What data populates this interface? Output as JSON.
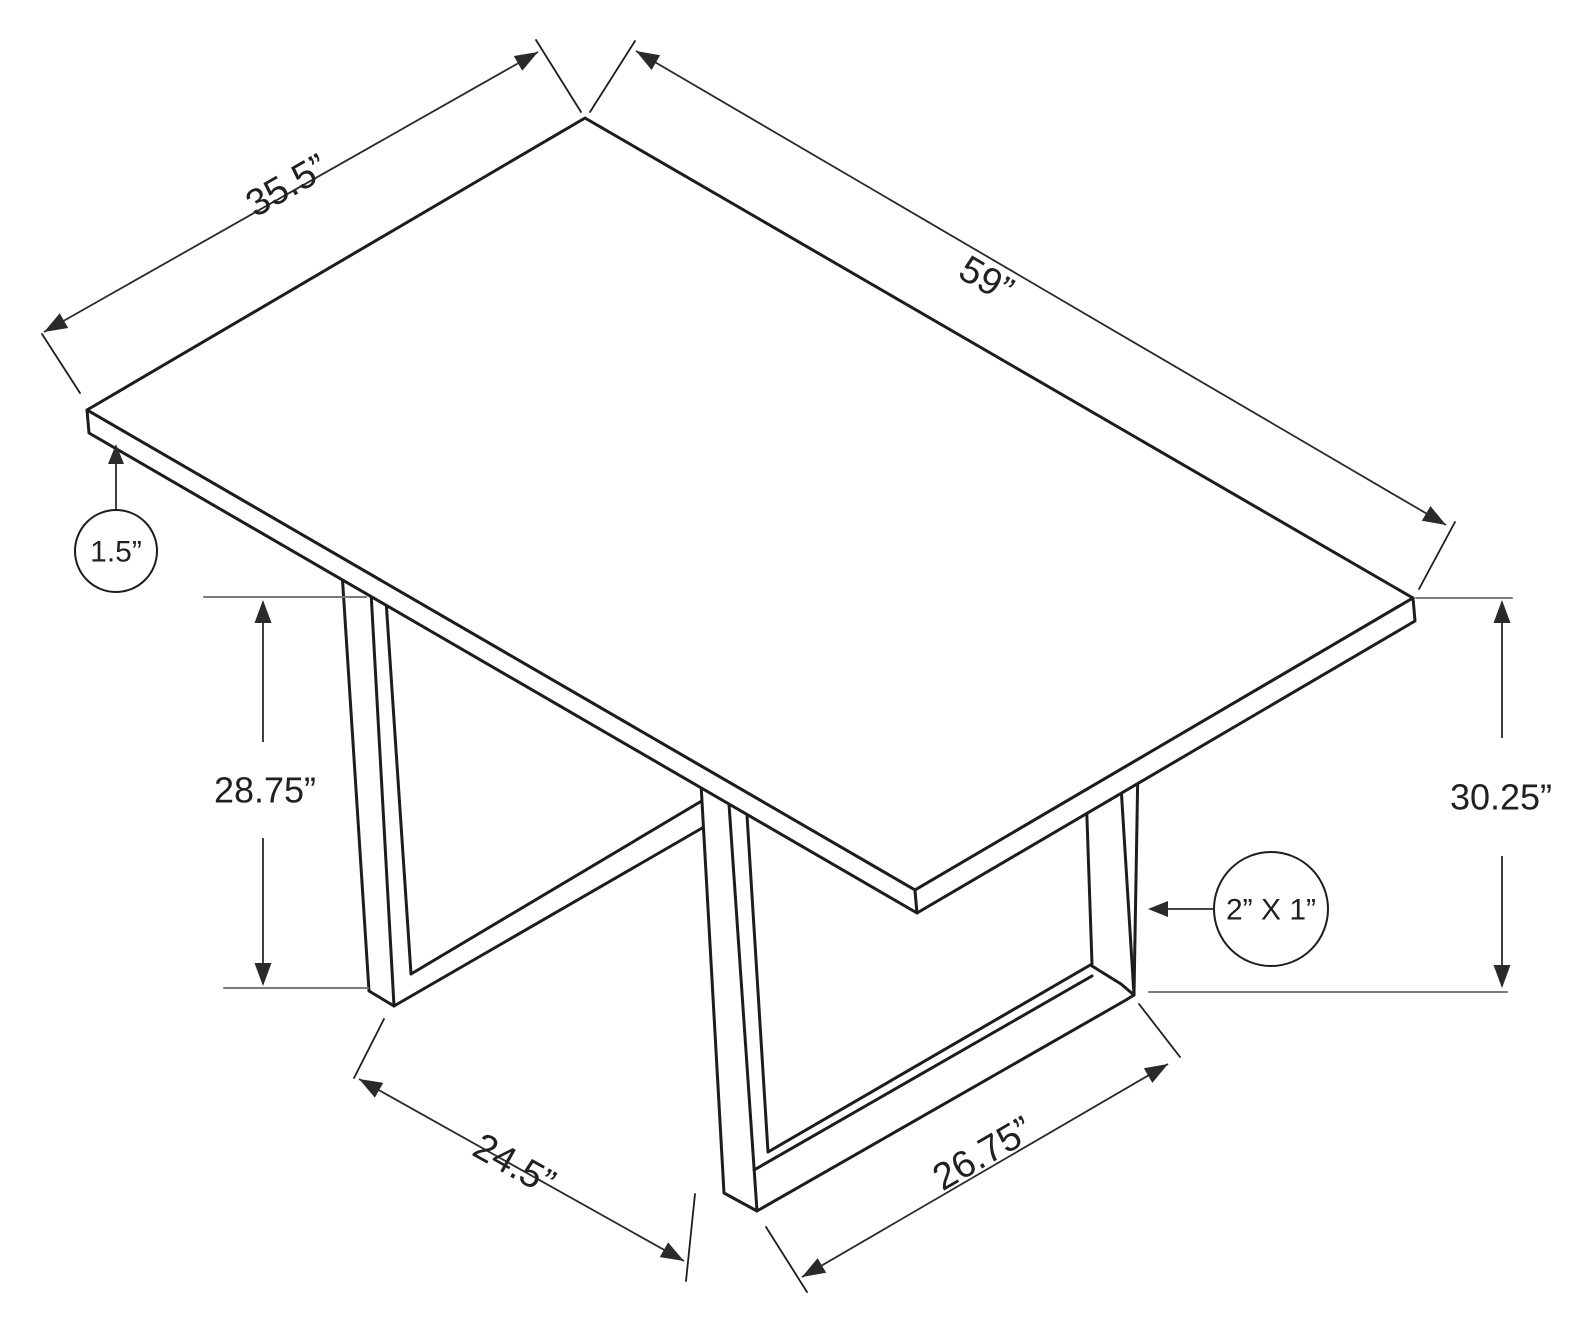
{
  "page": {
    "kind": "furniture dimension line drawing",
    "subject": "rectangular dining table with two U-shaped tube legs, isometric view"
  },
  "colors": {
    "background": "#ffffff",
    "line": "#1d1d1f",
    "dim_line": "#2a2a2c",
    "tick": "#7a7a7a",
    "text": "#231f20"
  },
  "canvas": {
    "width": 1585,
    "height": 1330
  },
  "chart_data": {
    "type": "table",
    "title": "Table dimensions (inches)",
    "dimension_labels": [
      "35.5”",
      "59”",
      "1.5”",
      "28.75”",
      "30.25”",
      "2” X 1”",
      "24.5”",
      "26.75”"
    ]
  },
  "diagram": {
    "elements": [
      {
        "type": "polygon",
        "name": "left-leg",
        "w": 3,
        "points": [
          [
            342,
            572
          ],
          [
            369,
            991
          ],
          [
            394,
            1006
          ],
          [
            742,
            805
          ],
          [
            742,
            777
          ],
          [
            411,
            974
          ],
          [
            386,
            600
          ]
        ]
      },
      {
        "type": "line",
        "name": "left-leg-front-corner-edge",
        "w": 3,
        "points": [
          [
            371,
            592
          ],
          [
            394,
            1006
          ]
        ]
      },
      {
        "type": "polygon",
        "name": "right-leg",
        "w": 3,
        "points": [
          [
            700,
            766
          ],
          [
            724,
            1193
          ],
          [
            757,
            1211
          ],
          [
            1126,
            1000
          ],
          [
            1134,
            995
          ],
          [
            1138,
            763
          ],
          [
            1085,
            761
          ],
          [
            1092,
            964
          ],
          [
            768,
            1152
          ],
          [
            745,
            783
          ]
        ]
      },
      {
        "type": "line",
        "name": "right-leg-front-corner-edge",
        "w": 3,
        "points": [
          [
            727,
            775
          ],
          [
            757,
            1211
          ]
        ]
      },
      {
        "type": "line",
        "name": "right-leg-rail-top-front-edge",
        "w": 3,
        "points": [
          [
            754,
            1170
          ],
          [
            1092,
            976
          ]
        ]
      },
      {
        "type": "line",
        "name": "right-leg-back-post-corner-edge",
        "w": 3,
        "points": [
          [
            1120,
            770
          ],
          [
            1134,
            995
          ]
        ]
      },
      {
        "type": "line",
        "name": "right-leg-back-foot-bevel",
        "w": 3,
        "points": [
          [
            1092,
            966
          ],
          [
            1121,
            984
          ],
          [
            1134,
            995
          ]
        ]
      },
      {
        "type": "polygon",
        "name": "tabletop-top-face",
        "w": 3,
        "points": [
          [
            585,
            118
          ],
          [
            1413,
            598
          ],
          [
            915,
            890
          ],
          [
            87,
            410
          ]
        ]
      },
      {
        "type": "polygon",
        "name": "tabletop-front-left-edge-band",
        "w": 3,
        "points": [
          [
            87,
            410
          ],
          [
            915,
            890
          ],
          [
            917,
            913
          ],
          [
            89,
            433
          ]
        ]
      },
      {
        "type": "polygon",
        "name": "tabletop-front-right-edge-band",
        "w": 3,
        "points": [
          [
            915,
            890
          ],
          [
            1413,
            598
          ],
          [
            1415,
            621
          ],
          [
            917,
            913
          ]
        ]
      },
      {
        "type": "line",
        "name": "tick-28-75-top",
        "w": 2,
        "color": "tick",
        "points": [
          [
            204,
            597
          ],
          [
            366,
            597
          ]
        ]
      },
      {
        "type": "line",
        "name": "tick-28-75-bottom",
        "w": 2,
        "color": "tick",
        "points": [
          [
            224,
            988
          ],
          [
            368,
            988
          ]
        ]
      },
      {
        "type": "line",
        "name": "tick-30-25-top",
        "w": 2,
        "color": "tick",
        "points": [
          [
            1416,
            598
          ],
          [
            1512,
            598
          ]
        ]
      },
      {
        "type": "line",
        "name": "floor-reference-line",
        "w": 2,
        "color": "tick",
        "points": [
          [
            1149,
            992
          ],
          [
            1507,
            992
          ]
        ]
      },
      {
        "type": "line",
        "name": "extension-35-5-left",
        "w": 1.8,
        "points": [
          [
            80,
            393
          ],
          [
            42,
            334
          ]
        ]
      },
      {
        "type": "line",
        "name": "extension-35-5-top",
        "w": 1.8,
        "points": [
          [
            581,
            112
          ],
          [
            536,
            40
          ]
        ]
      },
      {
        "type": "line",
        "name": "extension-59-top",
        "w": 1.8,
        "points": [
          [
            590,
            112
          ],
          [
            635,
            41
          ]
        ]
      },
      {
        "type": "line",
        "name": "extension-59-right",
        "w": 1.8,
        "points": [
          [
            1419,
            589
          ],
          [
            1455,
            522
          ]
        ]
      },
      {
        "type": "line",
        "name": "extension-24-5-left",
        "w": 1.8,
        "points": [
          [
            384,
            1019
          ],
          [
            354,
            1078
          ]
        ]
      },
      {
        "type": "line",
        "name": "extension-24-5-right",
        "w": 1.8,
        "points": [
          [
            695,
            1194
          ],
          [
            686,
            1281
          ]
        ]
      },
      {
        "type": "line",
        "name": "extension-26-75-left",
        "w": 1.8,
        "points": [
          [
            766,
            1227
          ],
          [
            807,
            1292
          ]
        ]
      },
      {
        "type": "line",
        "name": "extension-26-75-right",
        "w": 1.8,
        "points": [
          [
            1139,
            1004
          ],
          [
            1180,
            1057
          ]
        ]
      }
    ],
    "dims": [
      {
        "name": "dim-tabletop-width",
        "segments": [
          [
            44,
            332,
            538,
            52
          ]
        ],
        "arrows": [
          {
            "tip": [
              44,
              332
            ],
            "dir": [
              -0.868,
              0.497
            ]
          },
          {
            "tip": [
              538,
              52
            ],
            "dir": [
              0.868,
              -0.497
            ]
          }
        ],
        "label": {
          "text": "35.5”",
          "x": 287,
          "y": 186,
          "rot": -29.7,
          "size": 38
        }
      },
      {
        "name": "dim-tabletop-length",
        "segments": [
          [
            636,
            51,
            1446,
            525
          ]
        ],
        "arrows": [
          {
            "tip": [
              636,
              51
            ],
            "dir": [
              -0.863,
              -0.505
            ]
          },
          {
            "tip": [
              1446,
              525
            ],
            "dir": [
              0.863,
              0.505
            ]
          }
        ],
        "label": {
          "text": "59”",
          "x": 986,
          "y": 280,
          "rot": 30.3,
          "size": 38
        }
      },
      {
        "name": "dim-leg-clearance",
        "segments": [
          [
            359,
            1079,
            684,
            1261
          ]
        ],
        "arrows": [
          {
            "tip": [
              359,
              1079
            ],
            "dir": [
              -0.872,
              -0.489
            ]
          },
          {
            "tip": [
              684,
              1261
            ],
            "dir": [
              0.872,
              0.489
            ]
          }
        ],
        "label": {
          "text": "24.5”",
          "x": 514,
          "y": 1165,
          "rot": 29.3,
          "size": 38
        }
      },
      {
        "name": "dim-leg-base-depth",
        "segments": [
          [
            802,
            1277,
            1168,
            1064
          ]
        ],
        "arrows": [
          {
            "tip": [
              802,
              1277
            ],
            "dir": [
              -0.864,
              0.503
            ]
          },
          {
            "tip": [
              1168,
              1064
            ],
            "dir": [
              0.864,
              -0.503
            ]
          }
        ],
        "label": {
          "text": "26.75”",
          "x": 983,
          "y": 1154,
          "rot": -30.2,
          "size": 38
        }
      },
      {
        "name": "dim-leg-height",
        "segments": [
          [
            263,
            602,
            263,
            742
          ],
          [
            263,
            838,
            263,
            984
          ]
        ],
        "arrows": [
          {
            "tip": [
              263,
              600
            ],
            "dir": [
              0,
              -1
            ]
          },
          {
            "tip": [
              263,
              986
            ],
            "dir": [
              0,
              1
            ]
          }
        ],
        "label": {
          "text": "28.75”",
          "x": 265,
          "y": 790,
          "rot": 0,
          "size": 36
        }
      },
      {
        "name": "dim-table-height",
        "segments": [
          [
            1502,
            602,
            1502,
            738
          ],
          [
            1502,
            856,
            1502,
            986
          ]
        ],
        "arrows": [
          {
            "tip": [
              1502,
              600
            ],
            "dir": [
              0,
              -1
            ]
          },
          {
            "tip": [
              1502,
              988
            ],
            "dir": [
              0,
              1
            ]
          }
        ],
        "label": {
          "text": "30.25”",
          "x": 1501,
          "y": 797,
          "rot": 0,
          "size": 36
        }
      }
    ],
    "callouts": [
      {
        "name": "callout-tabletop-thickness",
        "cx": 116,
        "cy": 551,
        "r": 41,
        "text": "1.5”",
        "size": 30,
        "leader": [
          116,
          509,
          116,
          452
        ],
        "arrow": {
          "tip": [
            116,
            444
          ],
          "dir": [
            0,
            -1
          ]
        }
      },
      {
        "name": "callout-leg-tube-size",
        "cx": 1271,
        "cy": 909,
        "r": 57,
        "text": "2” X 1”",
        "size": 30,
        "leader": [
          1213,
          909,
          1162,
          909
        ],
        "arrow": {
          "tip": [
            1148,
            909
          ],
          "dir": [
            -1,
            0
          ]
        }
      }
    ]
  }
}
